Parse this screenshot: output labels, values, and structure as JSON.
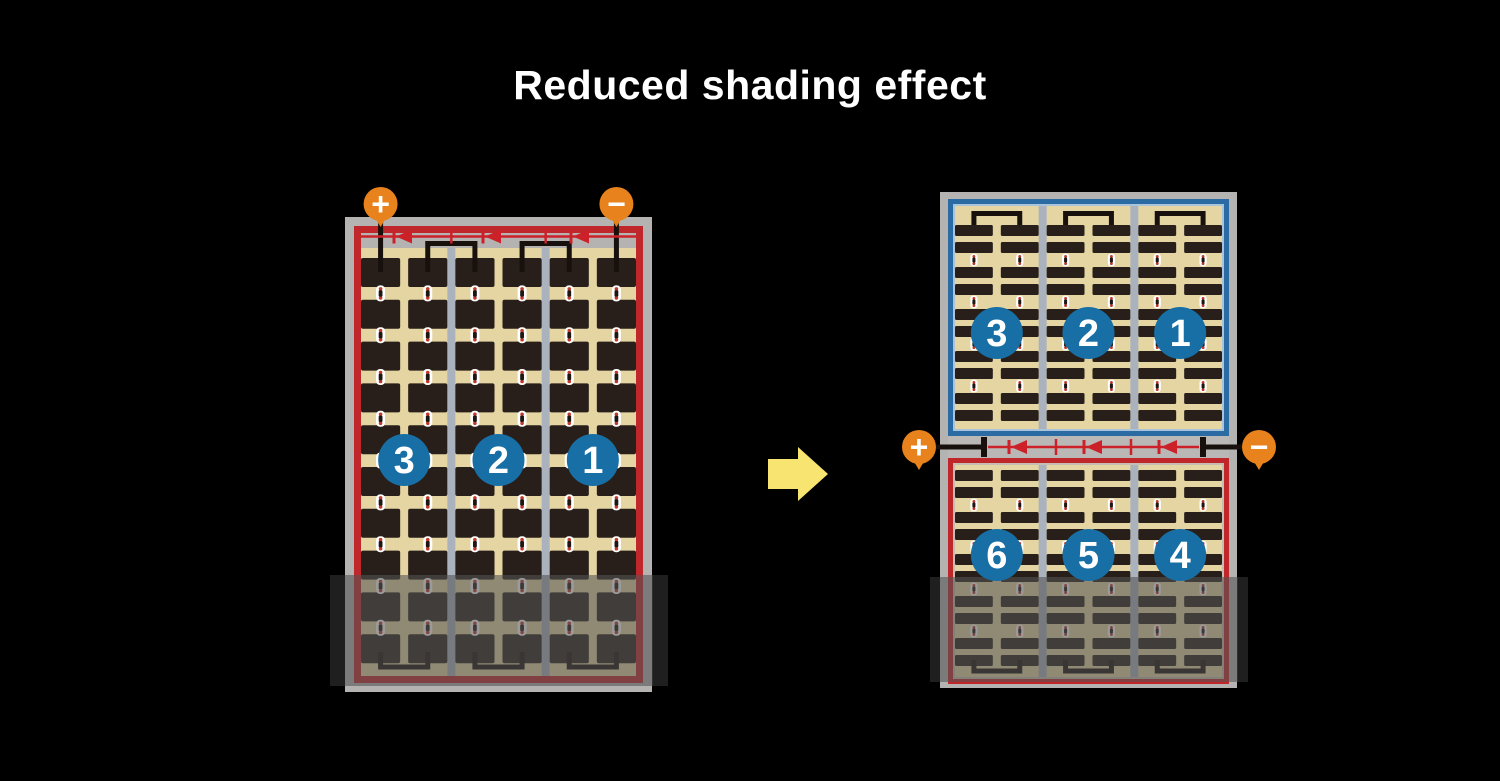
{
  "title": "Reduced shading effect",
  "left_panel": {
    "strings": [
      "3",
      "2",
      "1"
    ],
    "positive_label": "+",
    "negative_label": "−",
    "bypass_diodes": 3,
    "cell_columns": 6,
    "cell_rows": 10,
    "shaded_bottom": true
  },
  "arrow": {
    "direction": "right"
  },
  "right_panel": {
    "top_strings": [
      "3",
      "2",
      "1"
    ],
    "bottom_strings": [
      "6",
      "5",
      "4"
    ],
    "positive_label": "+",
    "negative_label": "−",
    "bypass_diodes": 3,
    "cell_columns": 6,
    "shaded_bottom": true
  },
  "colors": {
    "background": "#000000",
    "title_text": "#ffffff",
    "frame": "#b4b3b2",
    "border_red": "#c0272b",
    "border_blue": "#2b6ba3",
    "border_blue_inner": "#a9c3da",
    "border_red_inner": "#c6beb1",
    "cell_bg": "#e4d5a3",
    "cell": "#291f1a",
    "divider": "#aab3bd",
    "busbar": "#b9b8b6",
    "wire_red": "#cc2128",
    "wire_black": "#17100c",
    "terminal": "#e8821c",
    "terminal_text": "#ffffff",
    "circle": "#176fa5",
    "circle_text": "#ffffff",
    "connector_white": "#ffffff",
    "connector_red": "#c03a2a",
    "connector_dark": "#1d1612",
    "arrow": "#f8e470",
    "shade": "rgba(82,82,82,0.58)",
    "shade_cap": "rgba(0,0,0,0.35)"
  }
}
